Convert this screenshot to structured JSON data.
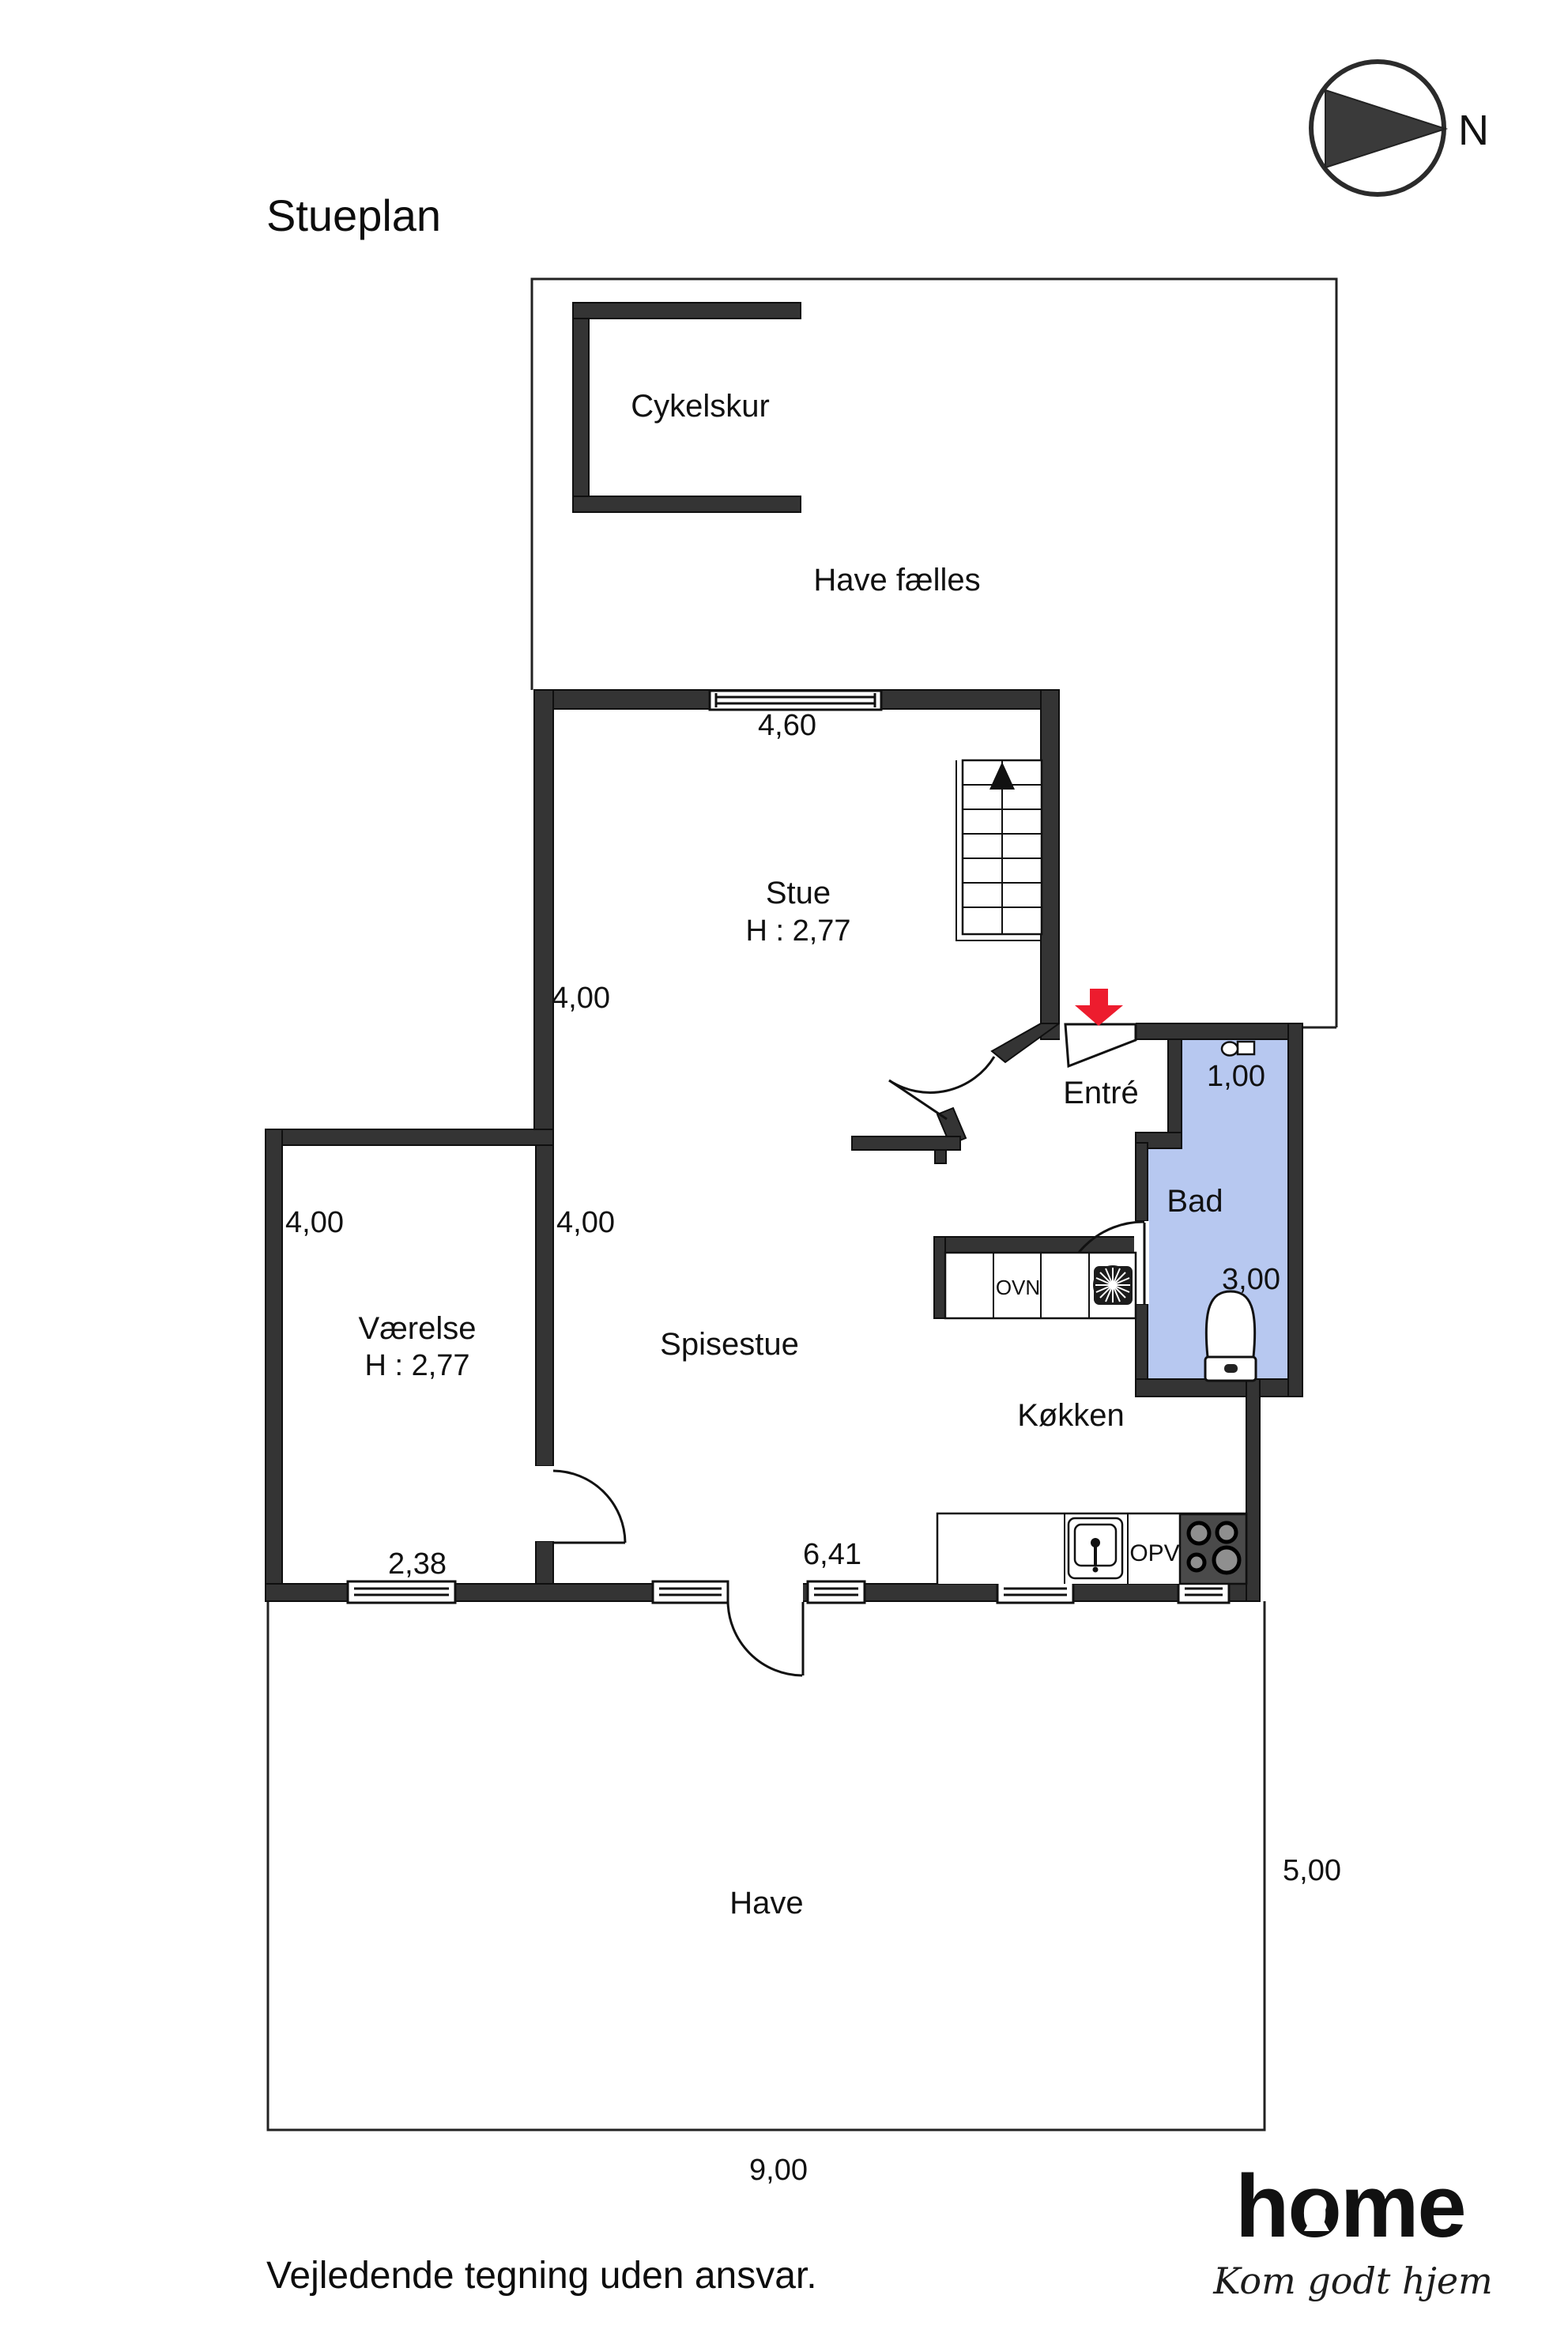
{
  "header": {
    "title": "Stueplan"
  },
  "compass": {
    "label": "N"
  },
  "plan": {
    "rooms": {
      "cykelskur": {
        "label": "Cykelskur"
      },
      "have_faelles": {
        "label": "Have fælles"
      },
      "stue": {
        "label": "Stue",
        "ceiling_height": "H : 2,77"
      },
      "entre": {
        "label": "Entré"
      },
      "bad": {
        "label": "Bad"
      },
      "vaerelse": {
        "label": "Værelse",
        "ceiling_height": "H : 2,77"
      },
      "spisestue": {
        "label": "Spisestue"
      },
      "koekken": {
        "label": "Køkken"
      },
      "have": {
        "label": "Have"
      }
    },
    "dimensions": {
      "stue_width_top": "4,60",
      "stue_depth_left": "4,00",
      "bad_width_top": "1,00",
      "vaerelse_depth_left": "4,00",
      "spisestue_depth_left": "4,00",
      "bad_depth_right": "3,00",
      "vaerelse_width_bottom": "2,38",
      "spisestue_width_bottom": "6,41",
      "have_depth_right": "5,00",
      "have_width_bottom": "9,00"
    },
    "appliances": {
      "oven_label": "OVN",
      "dishwasher_label": "OPV"
    },
    "colors": {
      "wall": "#343434",
      "bad_fill": "#b7c8f0",
      "entrance_arrow": "#ed1c2e"
    }
  },
  "footer": {
    "disclaimer": "Vejledende tegning uden ansvar."
  },
  "logo": {
    "brand": "home",
    "tagline": "Kom godt hjem",
    "brand_color": "#e8132b"
  }
}
